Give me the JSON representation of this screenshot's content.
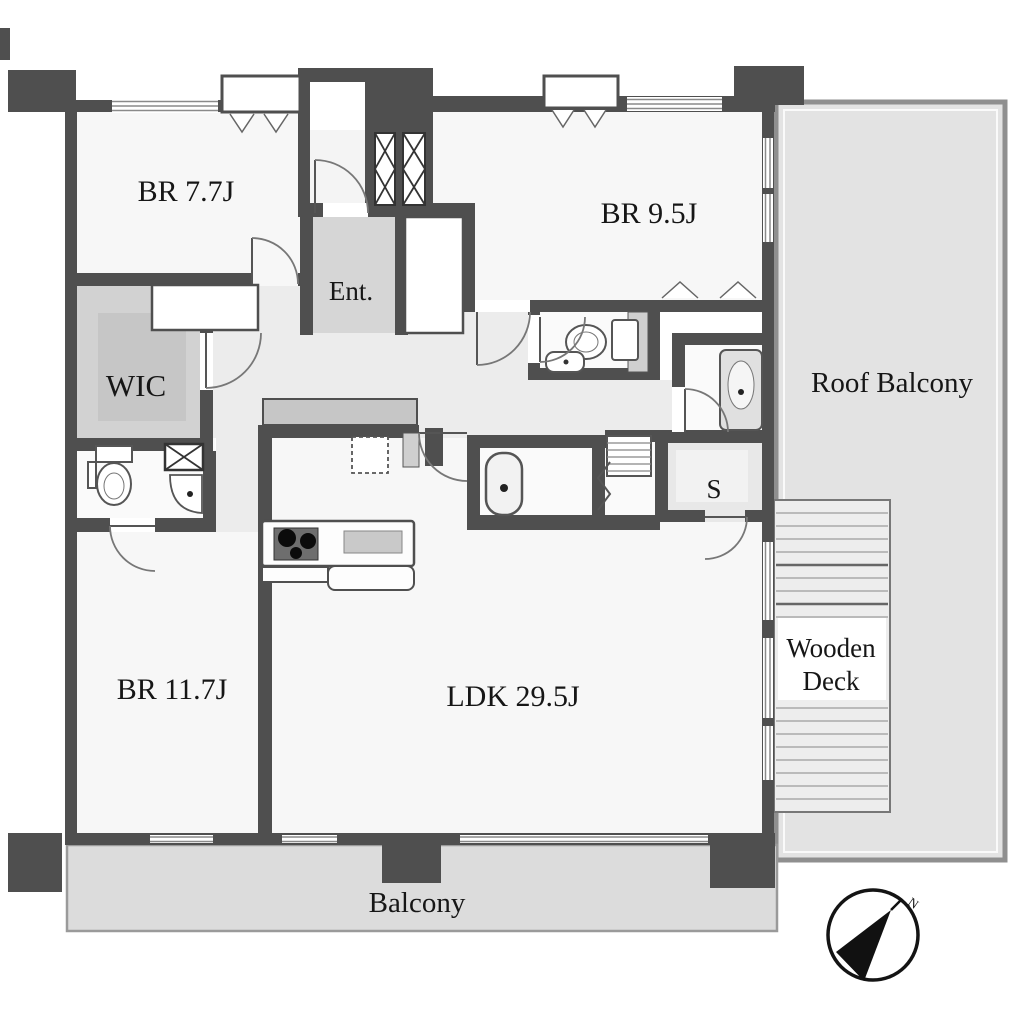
{
  "floor_plan": {
    "rooms": {
      "br_77": {
        "label": "BR 7.7J"
      },
      "br_95": {
        "label": "BR 9.5J"
      },
      "entrance": {
        "label": "Ent."
      },
      "wic": {
        "label": "WIC"
      },
      "roof_balcony": {
        "label": "Roof Balcony"
      },
      "storage": {
        "label": "S"
      },
      "wooden_deck": {
        "line1": "Wooden",
        "line2": "Deck"
      },
      "br_117": {
        "label": "BR 11.7J"
      },
      "ldk": {
        "label": "LDK 29.5J"
      },
      "balcony": {
        "label": "Balcony"
      }
    },
    "compass": {
      "north_label": "N"
    },
    "colors": {
      "wall": "#4f4f4f",
      "room_floor": "#f7f7f7",
      "corridor_floor": "#ececec",
      "entrance_floor": "#d6d6d6",
      "wic_floor": "#d2d2d2",
      "balcony_floor": "#dcdcdc",
      "roof_balcony_floor": "#e3e3e3",
      "label_text": "#161616"
    }
  }
}
